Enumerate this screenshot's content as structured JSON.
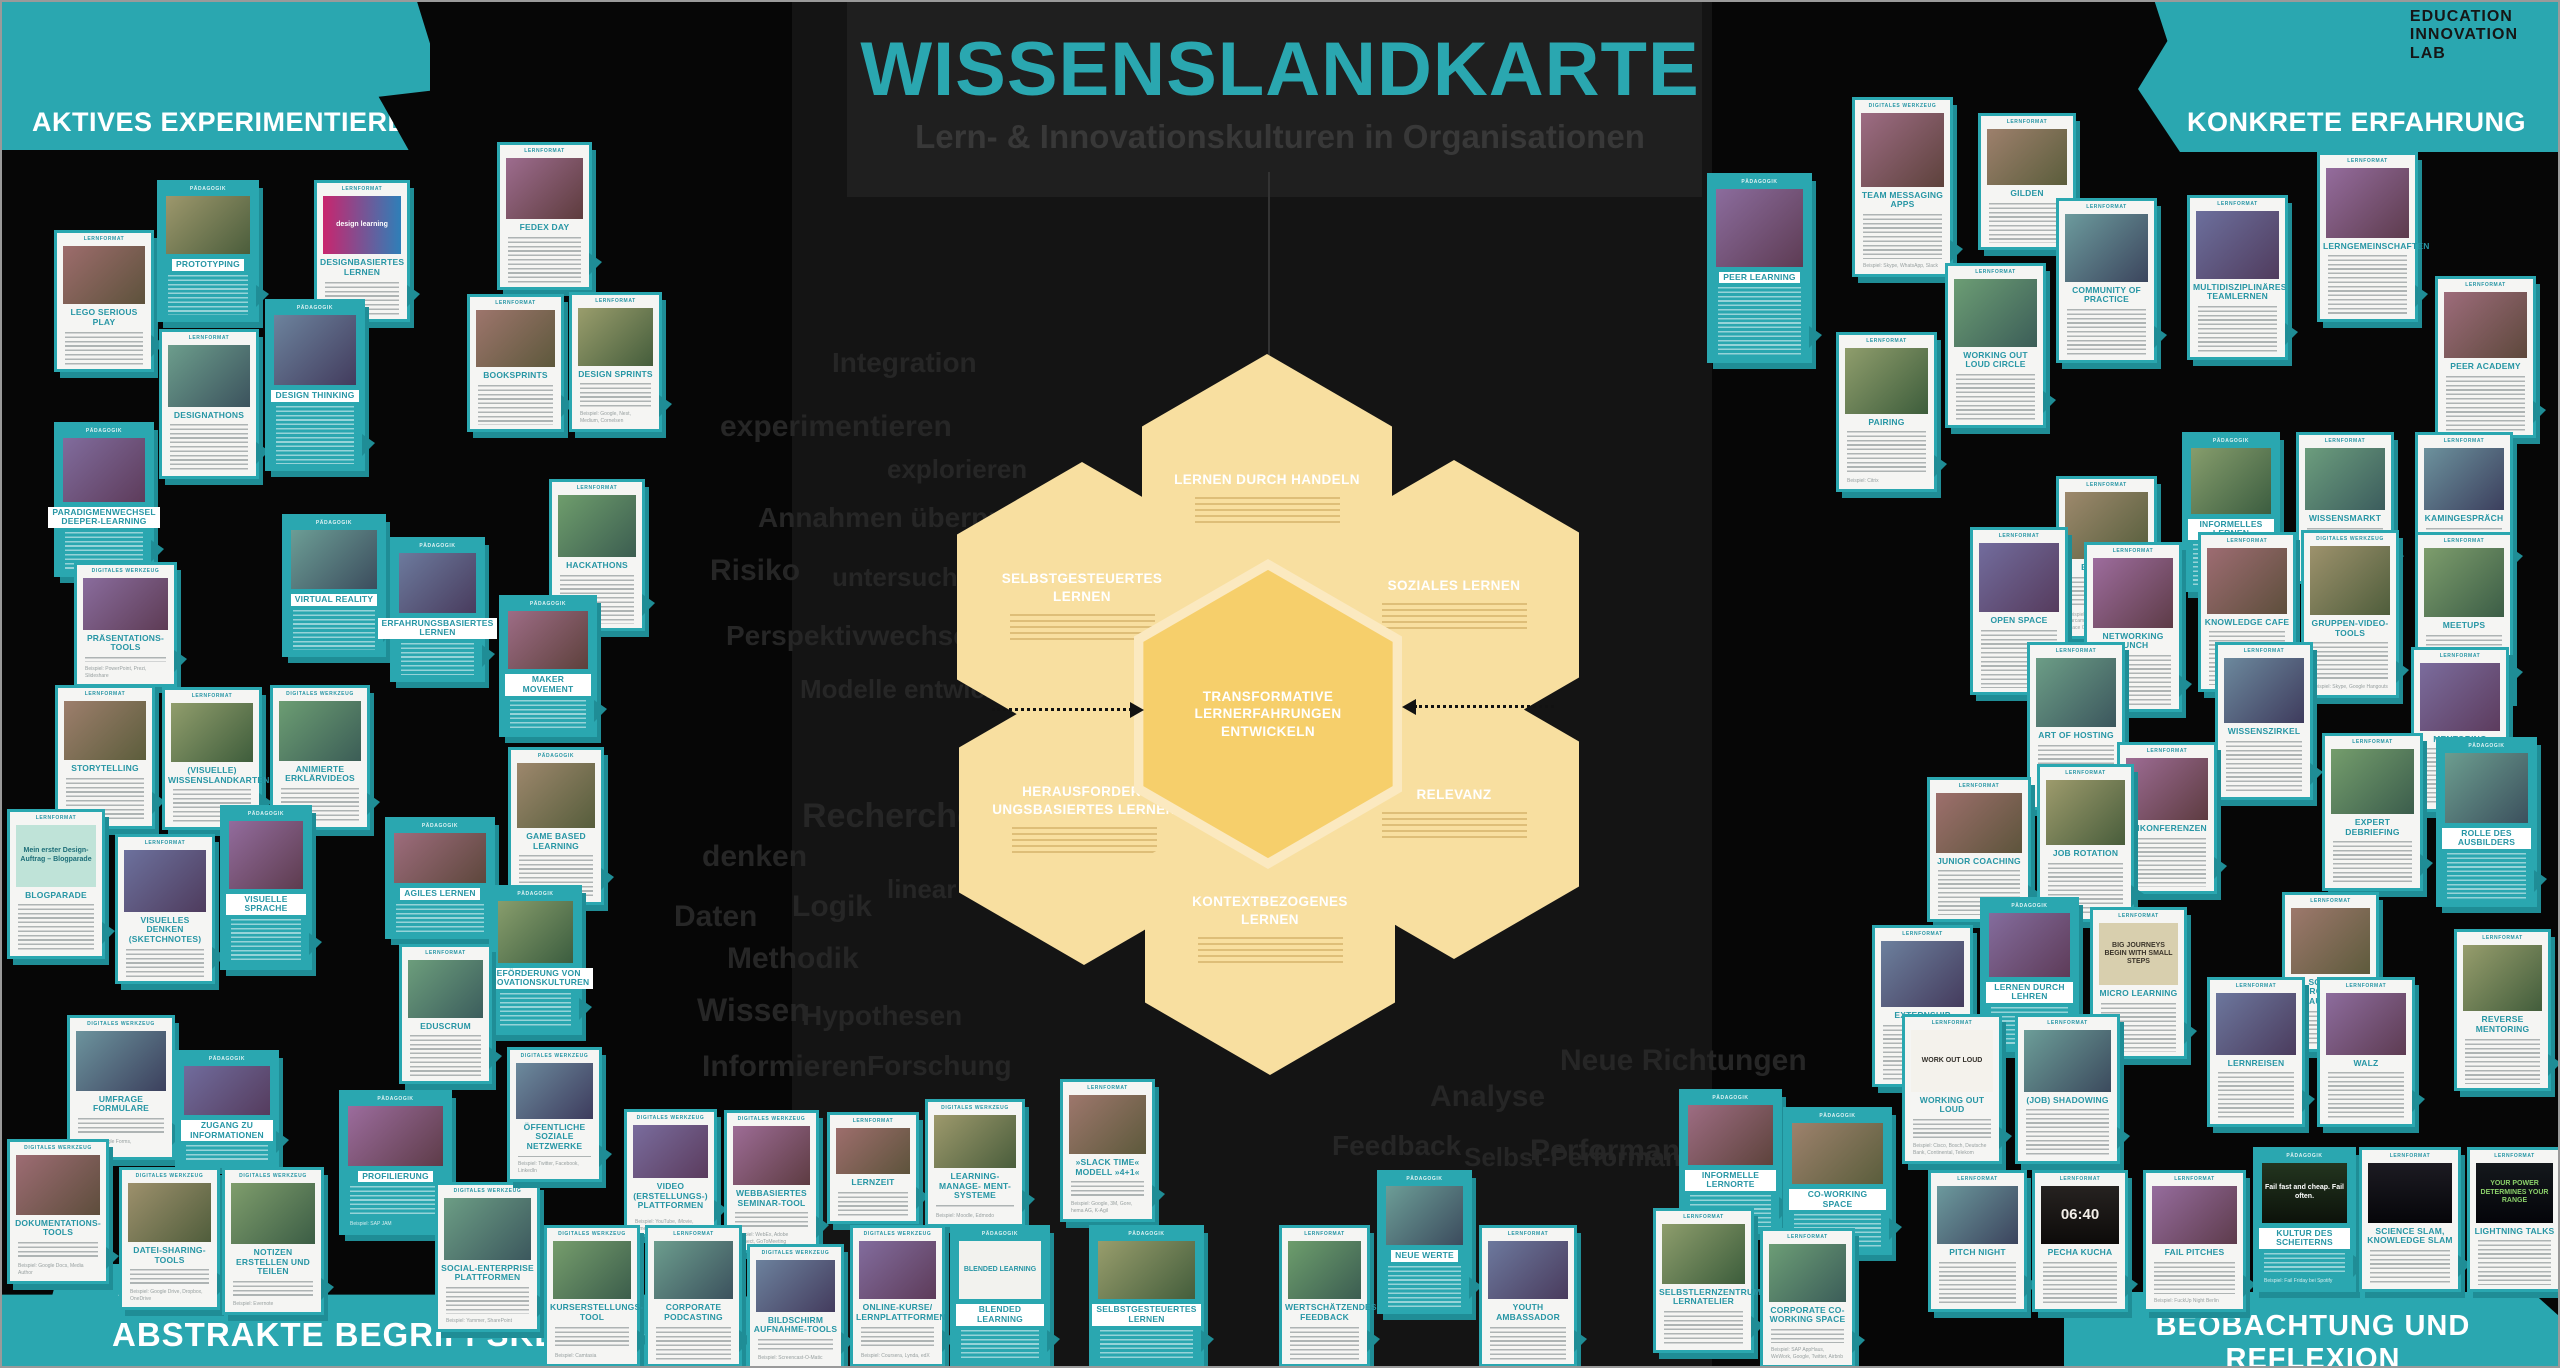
{
  "header": {
    "title": "WISSENSLANDKARTE",
    "subtitle": "Lern- & Innovationskulturen in Organisationen"
  },
  "logo": {
    "lines": [
      "EDUCATION",
      "INNOVATION",
      "LAB"
    ]
  },
  "quadrants": {
    "top_left": "AKTIVES EXPERIMENTIEREN",
    "top_right": "KONKRETE ERFAHRUNG",
    "bottom_left": "ABSTRAKTE BEGRIFFSKLÄRUNG",
    "bottom_left_note": "blog",
    "bottom_right": "BEOBACHTUNG UND REFLEXION"
  },
  "colors": {
    "teal": "#2AA7B0",
    "hex_light": "#F8DFA0",
    "hex_center": "#F6CF6B",
    "background": "#060606"
  },
  "hexagons": [
    {
      "label": "LERNEN DURCH HANDELN",
      "cx": 1265,
      "cy": 497,
      "center": false
    },
    {
      "label": "SELBSTGESTEUERTES LERNEN",
      "cx": 1080,
      "cy": 605,
      "center": false
    },
    {
      "label": "SOZIALES LERNEN",
      "cx": 1452,
      "cy": 603,
      "center": false
    },
    {
      "label": "HERAUSFORDER- UNGSBASIERTES LERNEN",
      "cx": 1082,
      "cy": 818,
      "center": false
    },
    {
      "label": "RELEVANZ",
      "cx": 1452,
      "cy": 812,
      "center": false
    },
    {
      "label": "KONTEXTBEZOGENES LERNEN",
      "cx": 1268,
      "cy": 928,
      "center": false
    },
    {
      "label": "TRANSFORMATIVE LERNERFAHRUNGEN ENTWICKELN",
      "cx": 1266,
      "cy": 712,
      "center": true
    }
  ],
  "background_words": [
    {
      "t": "Integration",
      "x": 830,
      "y": 345,
      "s": 28
    },
    {
      "t": "experimentieren",
      "x": 718,
      "y": 408,
      "s": 30
    },
    {
      "t": "explorieren",
      "x": 885,
      "y": 452,
      "s": 26
    },
    {
      "t": "Annahmen überprüfen",
      "x": 756,
      "y": 500,
      "s": 28
    },
    {
      "t": "Risiko",
      "x": 708,
      "y": 552,
      "s": 30
    },
    {
      "t": "untersuchen",
      "x": 830,
      "y": 560,
      "s": 26
    },
    {
      "t": "Perspektivwechsel",
      "x": 724,
      "y": 618,
      "s": 28
    },
    {
      "t": "Modelle entwickeln",
      "x": 798,
      "y": 672,
      "s": 26
    },
    {
      "t": "Recherche",
      "x": 800,
      "y": 795,
      "s": 34
    },
    {
      "t": "denken",
      "x": 700,
      "y": 838,
      "s": 30
    },
    {
      "t": "linear",
      "x": 885,
      "y": 872,
      "s": 26
    },
    {
      "t": "Logik",
      "x": 790,
      "y": 888,
      "s": 30
    },
    {
      "t": "Daten",
      "x": 672,
      "y": 898,
      "s": 30
    },
    {
      "t": "Methodik",
      "x": 725,
      "y": 940,
      "s": 30
    },
    {
      "t": "Wissen",
      "x": 695,
      "y": 990,
      "s": 32
    },
    {
      "t": "Hypothesen",
      "x": 800,
      "y": 998,
      "s": 28
    },
    {
      "t": "Informieren",
      "x": 700,
      "y": 1048,
      "s": 30
    },
    {
      "t": "Forschung",
      "x": 865,
      "y": 1048,
      "s": 28
    },
    {
      "t": "Analyse",
      "x": 1428,
      "y": 1078,
      "s": 30
    },
    {
      "t": "Feedback",
      "x": 1330,
      "y": 1128,
      "s": 28
    },
    {
      "t": "Selbst-Performance",
      "x": 1462,
      "y": 1140,
      "s": 26
    },
    {
      "t": "Neue Richtungen",
      "x": 1558,
      "y": 1042,
      "s": 30
    },
    {
      "t": "Performance",
      "x": 1528,
      "y": 1132,
      "s": 30
    }
  ],
  "cards": [
    {
      "t": "LEGO SERIOUS PLAY",
      "x": 52,
      "y": 228,
      "w": 100,
      "h": 142,
      "v": "w",
      "tag": "LERNFORMAT"
    },
    {
      "t": "PROTOTYPING",
      "x": 155,
      "y": 178,
      "w": 102,
      "h": 142,
      "v": "t",
      "tag": "PÄDAGOGIK"
    },
    {
      "t": "DESIGNBASIERTES LERNEN",
      "x": 312,
      "y": 178,
      "w": 96,
      "h": 142,
      "v": "w",
      "tag": "LERNFORMAT",
      "img": {
        "text": "design learning",
        "bg": "linear-gradient(90deg,#c9256e,#2e7fb8)",
        "fg": "#ffffff"
      }
    },
    {
      "t": "DESIGNATHONS",
      "x": 157,
      "y": 327,
      "w": 100,
      "h": 150,
      "v": "w",
      "tag": "LERNFORMAT"
    },
    {
      "t": "DESIGN THINKING",
      "x": 263,
      "y": 297,
      "w": 100,
      "h": 172,
      "v": "t",
      "tag": "PÄDAGOGIK"
    },
    {
      "t": "PARADIGMENWECHSEL DEEPER-LEARNING",
      "x": 52,
      "y": 420,
      "w": 100,
      "h": 155,
      "v": "t",
      "tag": "PÄDAGOGIK"
    },
    {
      "t": "FEDEX DAY",
      "x": 495,
      "y": 140,
      "w": 95,
      "h": 148,
      "v": "w",
      "tag": "LERNFORMAT"
    },
    {
      "t": "BOOKSPRINTS",
      "x": 465,
      "y": 292,
      "w": 97,
      "h": 138,
      "v": "w",
      "tag": "LERNFORMAT"
    },
    {
      "t": "DESIGN SPRINTS",
      "x": 567,
      "y": 290,
      "w": 93,
      "h": 140,
      "v": "w",
      "tag": "LERNFORMAT",
      "ex": "Beispiel: Google, Nest, Medium, Cornelsen"
    },
    {
      "t": "HACKATHONS",
      "x": 547,
      "y": 477,
      "w": 96,
      "h": 152,
      "v": "w",
      "tag": "LERNFORMAT"
    },
    {
      "t": "VIRTUAL REALITY",
      "x": 280,
      "y": 512,
      "w": 104,
      "h": 143,
      "v": "t",
      "tag": "PÄDAGOGIK"
    },
    {
      "t": "ERFAHRUNGSBASIERTES LERNEN",
      "x": 388,
      "y": 535,
      "w": 95,
      "h": 145,
      "v": "t",
      "tag": "PÄDAGOGIK"
    },
    {
      "t": "PRÄSENTATIONS-TOOLS",
      "x": 72,
      "y": 560,
      "w": 103,
      "h": 125,
      "v": "w",
      "tag": "DIGITALES WERKZEUG",
      "ex": "Beispiel: PowerPoint, Prezi, Slideshare"
    },
    {
      "t": "MAKER MOVEMENT",
      "x": 497,
      "y": 593,
      "w": 98,
      "h": 142,
      "v": "t",
      "tag": "PÄDAGOGIK"
    },
    {
      "t": "STORYTELLING",
      "x": 53,
      "y": 683,
      "w": 100,
      "h": 144,
      "v": "w",
      "tag": "LERNFORMAT"
    },
    {
      "t": "(VISUELLE) WISSENSLANDKARTEN",
      "x": 160,
      "y": 685,
      "w": 100,
      "h": 143,
      "v": "w",
      "tag": "LERNFORMAT"
    },
    {
      "t": "ANIMIERTE ERKLÄRVIDEOS",
      "x": 268,
      "y": 683,
      "w": 100,
      "h": 145,
      "v": "w",
      "tag": "DIGITALES WERKZEUG"
    },
    {
      "t": "BLOGPARADE",
      "x": 5,
      "y": 807,
      "w": 98,
      "h": 150,
      "v": "w",
      "tag": "LERNFORMAT",
      "img": {
        "text": "Mein erster Design-Auftrag – Blogparade",
        "bg": "#bfe3d8",
        "fg": "#1d6e78"
      }
    },
    {
      "t": "VISUELLES DENKEN (SKETCHNOTES)",
      "x": 113,
      "y": 832,
      "w": 100,
      "h": 150,
      "v": "w",
      "tag": "LERNFORMAT"
    },
    {
      "t": "VISUELLE SPRACHE",
      "x": 218,
      "y": 803,
      "w": 92,
      "h": 165,
      "v": "t",
      "tag": "PÄDAGOGIK"
    },
    {
      "t": "AGILES LERNEN",
      "x": 383,
      "y": 815,
      "w": 110,
      "h": 122,
      "v": "t",
      "tag": "PÄDAGOGIK"
    },
    {
      "t": "GAME BASED LEARNING",
      "x": 506,
      "y": 745,
      "w": 96,
      "h": 158,
      "v": "w",
      "tag": "PÄDAGOGIK"
    },
    {
      "t": "BEFÖRDERUNG VON INNOVATIONSKULTUREN",
      "x": 487,
      "y": 883,
      "w": 93,
      "h": 150,
      "v": "t",
      "tag": "PÄDAGOGIK"
    },
    {
      "t": "EDUSCRUM",
      "x": 397,
      "y": 942,
      "w": 93,
      "h": 140,
      "v": "w",
      "tag": "LERNFORMAT"
    },
    {
      "t": "UMFRAGE FORMULARE",
      "x": 65,
      "y": 1013,
      "w": 108,
      "h": 145,
      "v": "w",
      "tag": "DIGITALES WERKZEUG",
      "ex": "Beispiel: Google Forms, SurveyMonkey"
    },
    {
      "t": "ZUGANG ZU INFORMATIONEN",
      "x": 173,
      "y": 1048,
      "w": 104,
      "h": 118,
      "v": "t",
      "tag": "PÄDAGOGIK"
    },
    {
      "t": "PROFILIERUNG",
      "x": 337,
      "y": 1088,
      "w": 113,
      "h": 145,
      "v": "t",
      "tag": "PÄDAGOGIK",
      "ex": "Beispiel: SAP JAM"
    },
    {
      "t": "DOKUMENTATIONS-TOOLS",
      "x": 5,
      "y": 1137,
      "w": 102,
      "h": 145,
      "v": "w",
      "tag": "DIGITALES WERKZEUG",
      "ex": "Beispiel: Google Docs, Media Author"
    },
    {
      "t": "DATEI-SHARING-TOOLS",
      "x": 117,
      "y": 1165,
      "w": 101,
      "h": 143,
      "v": "w",
      "tag": "DIGITALES WERKZEUG",
      "ex": "Beispiel: Google Drive, Dropbox, OneDrive"
    },
    {
      "t": "NOTIZEN ERSTELLEN UND TEILEN",
      "x": 220,
      "y": 1165,
      "w": 102,
      "h": 148,
      "v": "w",
      "tag": "DIGITALES WERKZEUG",
      "ex": "Beispiel: Evernote"
    },
    {
      "t": "SOCIAL-ENTERPRISE PLATTFORMEN",
      "x": 433,
      "y": 1180,
      "w": 105,
      "h": 150,
      "v": "w",
      "tag": "DIGITALES WERKZEUG",
      "ex": "Beispiel: Yammer, SharePoint"
    },
    {
      "t": "ÖFFENTLICHE SOZIALE NETZWERKE",
      "x": 505,
      "y": 1045,
      "w": 95,
      "h": 135,
      "v": "w",
      "tag": "DIGITALES WERKZEUG",
      "ex": "Beispiel: Twitter, Facebook, LinkedIn"
    },
    {
      "t": "VIDEO (ERSTELLUNGS-) PLATTFORMEN",
      "x": 622,
      "y": 1107,
      "w": 93,
      "h": 128,
      "v": "w",
      "tag": "DIGITALES WERKZEUG",
      "ex": "Beispiel: YouTube, iMovie, Vimeo"
    },
    {
      "t": "WEBBASIERTES SEMINAR-TOOL",
      "x": 722,
      "y": 1108,
      "w": 95,
      "h": 143,
      "v": "w",
      "tag": "DIGITALES WERKZEUG",
      "ex": "Beispiel: WebEx, Adobe Connect, GoToMeeting"
    },
    {
      "t": "LERNZEIT",
      "x": 825,
      "y": 1110,
      "w": 92,
      "h": 112,
      "v": "w",
      "tag": "LERNFORMAT"
    },
    {
      "t": "LEARNING-MANAGE- MENT-SYSTEME",
      "x": 923,
      "y": 1097,
      "w": 100,
      "h": 128,
      "v": "w",
      "tag": "DIGITALES WERKZEUG",
      "ex": "Beispiel: Moodle, Edmodo"
    },
    {
      "t": "KURSERSTELLUNGS-TOOL",
      "x": 542,
      "y": 1223,
      "w": 96,
      "h": 142,
      "v": "w",
      "tag": "DIGITALES WERKZEUG",
      "ex": "Beispiel: Camtasia"
    },
    {
      "t": "CORPORATE PODCASTING",
      "x": 643,
      "y": 1223,
      "w": 97,
      "h": 142,
      "v": "w",
      "tag": "LERNFORMAT"
    },
    {
      "t": "BILDSCHIRM AUFNAHME-TOOLS",
      "x": 745,
      "y": 1242,
      "w": 97,
      "h": 125,
      "v": "w",
      "tag": "DIGITALES WERKZEUG",
      "ex": "Beispiel: Screencast-O-Matic"
    },
    {
      "t": "ONLINE-KURSE/ LERNPLATTFORMEN",
      "x": 848,
      "y": 1223,
      "w": 95,
      "h": 142,
      "v": "w",
      "tag": "DIGITALES WERKZEUG",
      "ex": "Beispiel: Coursera, Lynda, edX"
    },
    {
      "t": "BLENDED LEARNING",
      "x": 948,
      "y": 1223,
      "w": 100,
      "h": 142,
      "v": "t",
      "tag": "PÄDAGOGIK",
      "img": {
        "text": "BLENDED LEARNING",
        "bg": "#f2f2ee",
        "fg": "#2796a5"
      }
    },
    {
      "t": "»SLACK TIME« MODELL »4+1«",
      "x": 1058,
      "y": 1077,
      "w": 95,
      "h": 143,
      "v": "w",
      "tag": "LERNFORMAT",
      "ex": "Beispiel: Google, 3M, Gore, hema AG, K-Agil"
    },
    {
      "t": "SELBSTGESTEUERTES LERNEN",
      "x": 1087,
      "y": 1223,
      "w": 115,
      "h": 142,
      "v": "t",
      "tag": "PÄDAGOGIK"
    },
    {
      "t": "WERTSCHÄTZENDES FEEDBACK",
      "x": 1277,
      "y": 1223,
      "w": 91,
      "h": 142,
      "v": "w",
      "tag": "LERNFORMAT"
    },
    {
      "t": "NEUE WERTE",
      "x": 1375,
      "y": 1168,
      "w": 95,
      "h": 144,
      "v": "t",
      "tag": "PÄDAGOGIK"
    },
    {
      "t": "YOUTH AMBASSADOR",
      "x": 1477,
      "y": 1223,
      "w": 98,
      "h": 142,
      "v": "w",
      "tag": "LERNFORMAT"
    },
    {
      "t": "PEER LEARNING",
      "x": 1705,
      "y": 171,
      "w": 105,
      "h": 190,
      "v": "t",
      "tag": "PÄDAGOGIK"
    },
    {
      "t": "TEAM MESSAGING APPS",
      "x": 1850,
      "y": 95,
      "w": 101,
      "h": 180,
      "v": "w",
      "tag": "DIGITALES WERKZEUG",
      "ex": "Beispiel: Skype, WhatsApp, Slack"
    },
    {
      "t": "GILDEN",
      "x": 1976,
      "y": 111,
      "w": 98,
      "h": 137,
      "v": "w",
      "tag": "LERNFORMAT"
    },
    {
      "t": "PAIRING",
      "x": 1834,
      "y": 330,
      "w": 101,
      "h": 160,
      "v": "w",
      "tag": "LERNFORMAT",
      "ex": "Beispiel: Citrix"
    },
    {
      "t": "WORKING OUT LOUD CIRCLE",
      "x": 1943,
      "y": 261,
      "w": 101,
      "h": 165,
      "v": "w",
      "tag": "LERNFORMAT"
    },
    {
      "t": "COMMUNITY OF PRACTICE",
      "x": 2054,
      "y": 196,
      "w": 101,
      "h": 165,
      "v": "w",
      "tag": "LERNFORMAT"
    },
    {
      "t": "MULTIDISZIPLINÄRES TEAMLERNEN",
      "x": 2185,
      "y": 193,
      "w": 101,
      "h": 165,
      "v": "w",
      "tag": "LERNFORMAT"
    },
    {
      "t": "LERNGEMEINSCHAFTEN",
      "x": 2315,
      "y": 150,
      "w": 101,
      "h": 170,
      "v": "w",
      "tag": "LERNFORMAT"
    },
    {
      "t": "PEER ACADEMY",
      "x": 2433,
      "y": 274,
      "w": 101,
      "h": 162,
      "v": "w",
      "tag": "LERNFORMAT"
    },
    {
      "t": "BARCAMPS",
      "x": 2054,
      "y": 474,
      "w": 101,
      "h": 163,
      "v": "w",
      "tag": "LERNFORMAT",
      "ex": "Beispiel: Audi Zusammenarbeit 2.0 Barcamp, Commerzbank open space CLUB, Telekom Barcamp"
    },
    {
      "t": "INFORMELLES LERNEN",
      "x": 2180,
      "y": 430,
      "w": 98,
      "h": 160,
      "v": "t",
      "tag": "PÄDAGOGIK"
    },
    {
      "t": "WISSENSMARKT",
      "x": 2294,
      "y": 430,
      "w": 98,
      "h": 152,
      "v": "w",
      "tag": "LERNFORMAT"
    },
    {
      "t": "KAMINGESPRÄCH",
      "x": 2413,
      "y": 430,
      "w": 98,
      "h": 152,
      "v": "w",
      "tag": "LERNFORMAT"
    },
    {
      "t": "OPEN SPACE",
      "x": 1968,
      "y": 525,
      "w": 98,
      "h": 168,
      "v": "w",
      "tag": "LERNFORMAT"
    },
    {
      "t": "NETWORKING LUNCH",
      "x": 2082,
      "y": 540,
      "w": 98,
      "h": 170,
      "v": "w",
      "tag": "LERNFORMAT"
    },
    {
      "t": "KNOWLEDGE CAFE",
      "x": 2196,
      "y": 530,
      "w": 98,
      "h": 160,
      "v": "w",
      "tag": "LERNFORMAT"
    },
    {
      "t": "GRUPPEN-VIDEO-TOOLS",
      "x": 2299,
      "y": 528,
      "w": 98,
      "h": 168,
      "v": "w",
      "tag": "DIGITALES WERKZEUG",
      "ex": "Beispiel: Skype, Google Hangouts"
    },
    {
      "t": "MEETUPS",
      "x": 2413,
      "y": 530,
      "w": 98,
      "h": 168,
      "v": "w",
      "tag": "LERNFORMAT"
    },
    {
      "t": "ART OF HOSTING",
      "x": 2025,
      "y": 640,
      "w": 98,
      "h": 168,
      "v": "w",
      "tag": "LERNFORMAT"
    },
    {
      "t": "WISSENSZIRKEL",
      "x": 2213,
      "y": 640,
      "w": 98,
      "h": 158,
      "v": "w",
      "tag": "LERNFORMAT"
    },
    {
      "t": "MENTORING",
      "x": 2409,
      "y": 645,
      "w": 98,
      "h": 165,
      "v": "w",
      "tag": "LERNFORMAT"
    },
    {
      "t": "UNKONFERENZEN",
      "x": 2115,
      "y": 740,
      "w": 100,
      "h": 152,
      "v": "w",
      "tag": "LERNFORMAT"
    },
    {
      "t": "JUNIOR COACHING",
      "x": 1925,
      "y": 775,
      "w": 104,
      "h": 145,
      "v": "w",
      "tag": "LERNFORMAT"
    },
    {
      "t": "JOB ROTATION",
      "x": 2035,
      "y": 762,
      "w": 97,
      "h": 158,
      "v": "w",
      "tag": "LERNFORMAT"
    },
    {
      "t": "EXPERT DEBRIEFING",
      "x": 2320,
      "y": 731,
      "w": 101,
      "h": 158,
      "v": "w",
      "tag": "LERNFORMAT"
    },
    {
      "t": "ROLLE DES AUSBILDERS",
      "x": 2434,
      "y": 735,
      "w": 101,
      "h": 170,
      "v": "t",
      "tag": "PÄDAGOGIK"
    },
    {
      "t": "EXTERNSHIP",
      "x": 1870,
      "y": 923,
      "w": 101,
      "h": 162,
      "v": "w",
      "tag": "LERNFORMAT"
    },
    {
      "t": "LERNEN DURCH LEHREN",
      "x": 1978,
      "y": 895,
      "w": 99,
      "h": 155,
      "v": "t",
      "tag": "PÄDAGOGIK"
    },
    {
      "t": "MICRO LEARNING",
      "x": 2088,
      "y": 905,
      "w": 97,
      "h": 152,
      "v": "w",
      "tag": "LERNFORMAT",
      "img": {
        "text": "BIG JOURNEYS BEGIN WITH SMALL STEPS",
        "bg": "#d8cfae",
        "fg": "#3a342a"
      }
    },
    {
      "t": "SOZIALES PROJEKT IM AUSLAND",
      "x": 2280,
      "y": 890,
      "w": 97,
      "h": 160,
      "v": "w",
      "tag": "LERNFORMAT"
    },
    {
      "t": "REVERSE MENTORING",
      "x": 2452,
      "y": 927,
      "w": 97,
      "h": 162,
      "v": "w",
      "tag": "LERNFORMAT"
    },
    {
      "t": "WORKING OUT LOUD",
      "x": 1900,
      "y": 1012,
      "w": 100,
      "h": 150,
      "v": "w",
      "tag": "LERNFORMAT",
      "ex": "Beispiel: Cisco, Bosch, Deutsche Bank, Continental, Telekom",
      "img": {
        "text": "WORK OUT LOUD",
        "bg": "#f4f2ec",
        "fg": "#33302a"
      }
    },
    {
      "t": "(JOB) SHADOWING",
      "x": 2013,
      "y": 1012,
      "w": 105,
      "h": 150,
      "v": "w",
      "tag": "LERNFORMAT"
    },
    {
      "t": "LERNREISEN",
      "x": 2205,
      "y": 975,
      "w": 98,
      "h": 150,
      "v": "w",
      "tag": "LERNFORMAT"
    },
    {
      "t": "WALZ",
      "x": 2315,
      "y": 975,
      "w": 98,
      "h": 150,
      "v": "w",
      "tag": "LERNFORMAT"
    },
    {
      "t": "INFORMELLE LERNORTE",
      "x": 1677,
      "y": 1087,
      "w": 103,
      "h": 145,
      "v": "t",
      "tag": "PÄDAGOGIK"
    },
    {
      "t": "CO-WORKING SPACE",
      "x": 1781,
      "y": 1105,
      "w": 109,
      "h": 148,
      "v": "t",
      "tag": "PÄDAGOGIK"
    },
    {
      "t": "SELBSTLERNZENTRUM/ LERNATELIER",
      "x": 1651,
      "y": 1206,
      "w": 101,
      "h": 145,
      "v": "w",
      "tag": "LERNFORMAT"
    },
    {
      "t": "CORPORATE CO- WORKING SPACE",
      "x": 1758,
      "y": 1226,
      "w": 95,
      "h": 140,
      "v": "w",
      "tag": "LERNFORMAT",
      "ex": "Beispiel: SAP AppHaus, WeWork, Google, Twitter, Airbnb"
    },
    {
      "t": "PITCH NIGHT",
      "x": 1926,
      "y": 1168,
      "w": 99,
      "h": 142,
      "v": "w",
      "tag": "LERNFORMAT"
    },
    {
      "t": "PECHA KUCHA",
      "x": 2030,
      "y": 1168,
      "w": 96,
      "h": 142,
      "v": "w",
      "tag": "LERNFORMAT",
      "img": {
        "text": "06:40",
        "bg": "linear-gradient(#262220,#0d0b0a)",
        "fg": "#f3efe9"
      }
    },
    {
      "t": "FAIL PITCHES",
      "x": 2141,
      "y": 1168,
      "w": 103,
      "h": 142,
      "v": "w",
      "tag": "LERNFORMAT",
      "ex": "Beispiel: FuckUp Night Berlin"
    },
    {
      "t": "KULTUR DES SCHEITERNS",
      "x": 2251,
      "y": 1145,
      "w": 103,
      "h": 145,
      "v": "t",
      "tag": "PÄDAGOGIK",
      "ex": "Beispiel: Fail Friday bei Spotify",
      "img": {
        "text": "Fail fast and cheap. Fail often.",
        "bg": "linear-gradient(#23351f,#0c120a)",
        "fg": "#ffffff"
      }
    },
    {
      "t": "SCIENCE SLAM, KNOWLEDGE SLAM",
      "x": 2357,
      "y": 1145,
      "w": 102,
      "h": 145,
      "v": "w",
      "tag": "LERNFORMAT",
      "img": {
        "text": "",
        "bg": "linear-gradient(#1c1b22,#06060a)",
        "fg": "#ffffff"
      }
    },
    {
      "t": "LIGHTNING TALKS",
      "x": 2465,
      "y": 1145,
      "w": 95,
      "h": 145,
      "v": "w",
      "tag": "LERNFORMAT",
      "img": {
        "text": "YOUR POWER DETERMINES YOUR RANGE",
        "bg": "linear-gradient(#14181c,#04050a)",
        "fg": "#8bd06a"
      }
    }
  ]
}
